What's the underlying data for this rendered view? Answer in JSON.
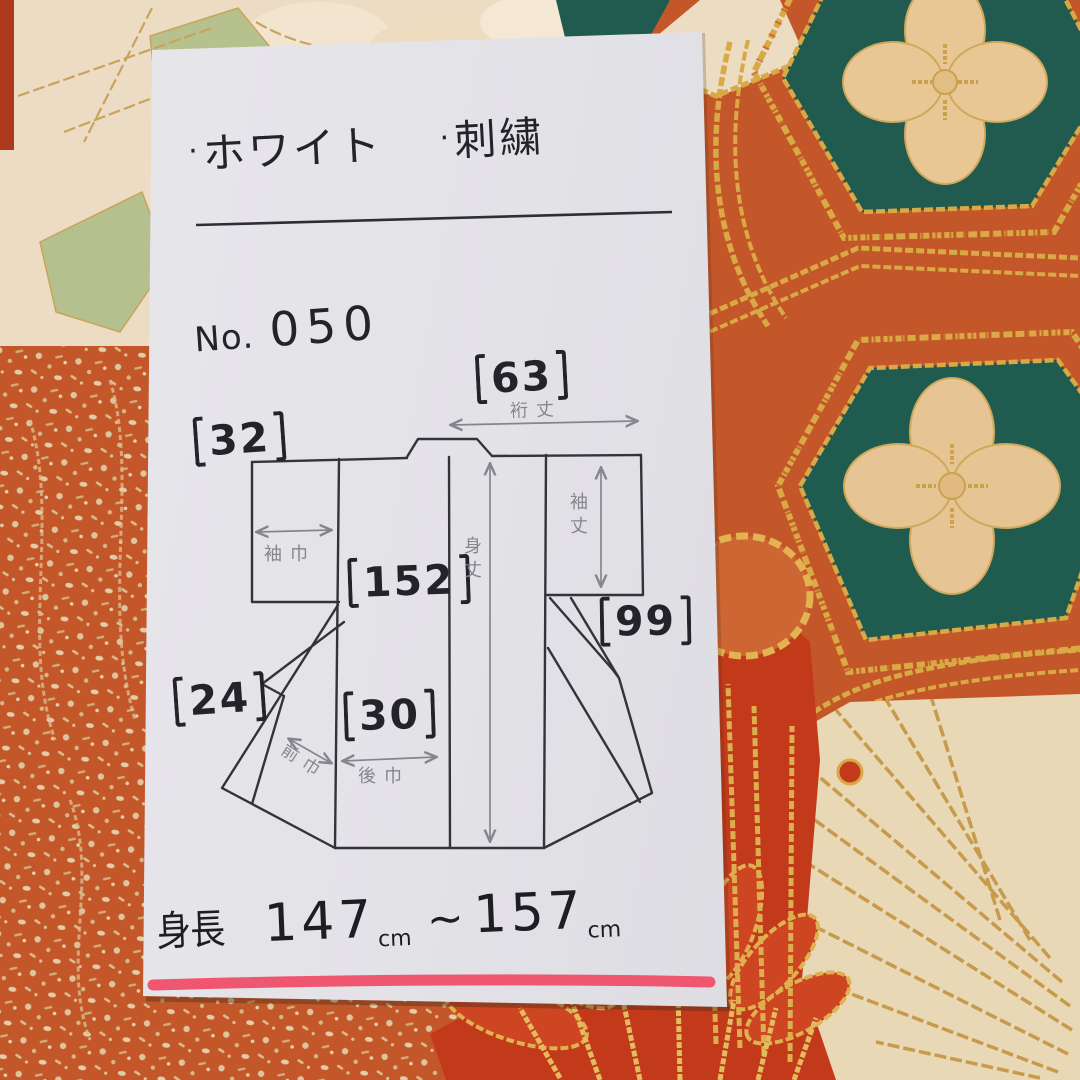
{
  "note_card": {
    "bullet_items": [
      {
        "dot": "·",
        "label": "ホワイト"
      },
      {
        "dot": "·",
        "label": "刺繍"
      }
    ],
    "number_line": {
      "prefix": "No.",
      "value": "050"
    },
    "diagram": {
      "measurements": {
        "yuki": {
          "display": "【63】",
          "value": "63",
          "label": "裄丈"
        },
        "sode_haba": {
          "display": "【32】",
          "value": "32",
          "label": "袖巾"
        },
        "mi_take": {
          "display": "【152】",
          "value": "152",
          "label": "身丈"
        },
        "sode_take": {
          "display": "【99】",
          "value": "99",
          "label": "袖丈"
        },
        "mae_haba": {
          "display": "【24】",
          "value": "24",
          "label": "前巾"
        },
        "ushiro_haba": {
          "display": "【30】",
          "value": "30",
          "label": "後巾"
        }
      }
    },
    "height_line": {
      "label": "身長",
      "from_value": "147",
      "from_unit": "cm",
      "separator": "~",
      "to_value": "157",
      "to_unit": "cm"
    }
  },
  "palette": {
    "card": "#e3e2e7",
    "fabric_orange": "#c4572a",
    "teal_hexagon": "#215a4e",
    "clover_cream": "#e9c795",
    "silk_cream": "#e9d8b5",
    "gold_thread": "#d8a944",
    "red_embroidery": "#c33a1b",
    "underline_pink": "#ef5670",
    "ink": "#232329",
    "pencil": "#86858d"
  }
}
